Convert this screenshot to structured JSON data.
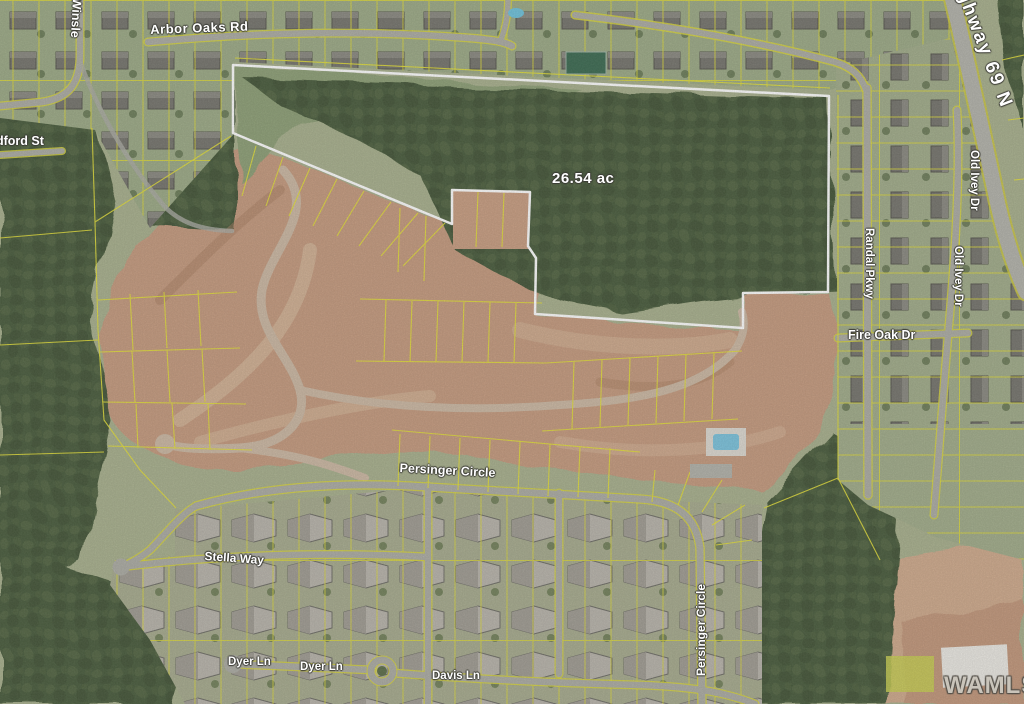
{
  "map": {
    "description": "Aerial satellite map of a subdivision parcel with lot lines",
    "acreage_label": "26.54 ac",
    "watermark": "WAMLS",
    "road_labels": {
      "arbor_oaks": "Arbor Oaks Rd",
      "winslet_st": "Winsle",
      "bedford_st": "dford St",
      "highway_69": "Highway 69 N",
      "randall_pkwy": "Randal Pkwy",
      "old_ivey_dr_1": "Old Ivey Dr",
      "old_ivey_dr_2": "Old Ivey Dr",
      "fire_oak_dr": "Fire Oak Dr",
      "persinger_circle_h": "Persinger Circle",
      "persinger_circle_v": "Persinger Circle",
      "stella_way": "Stella Way",
      "dyer_ln_1": "Dyer Ln",
      "dyer_ln_2": "Dyer Ln",
      "davis_ln": "Davis Ln"
    },
    "colors": {
      "parcel_boundary": "#ffffff",
      "lot_lines": "#e3df3a",
      "forest": "#4a5c3c",
      "cleared_dirt": "#c69b7f",
      "road": "#adada5",
      "label_text": "#ffffff",
      "watermark_text": "#c9c4ba"
    }
  }
}
